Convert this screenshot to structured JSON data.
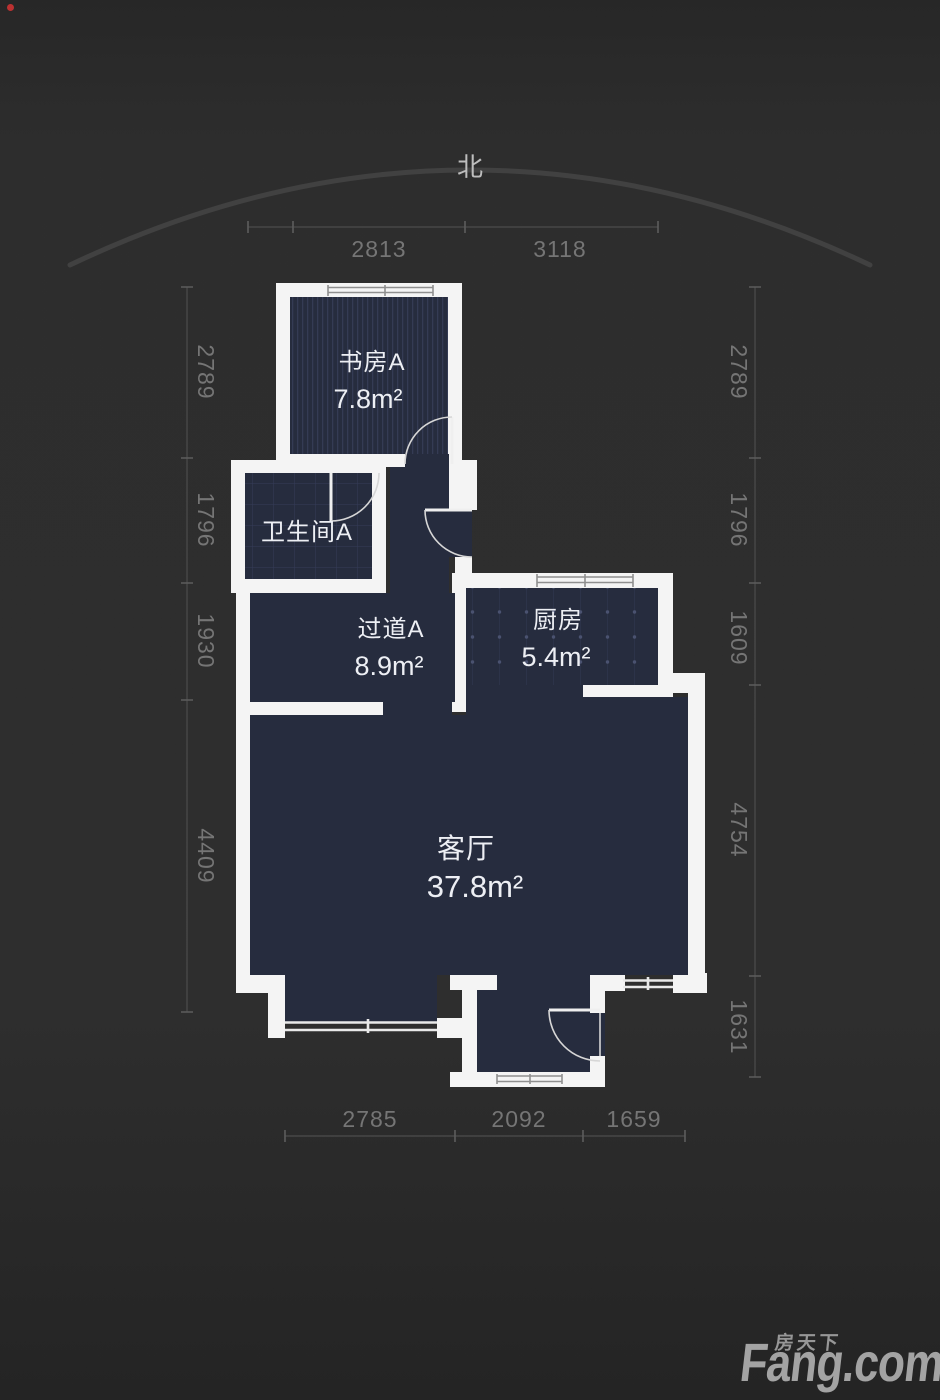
{
  "page": {
    "background": "#2e2e2e"
  },
  "compass": {
    "label": "北"
  },
  "rooms": {
    "study": {
      "name": "书房A",
      "area": "7.8m²"
    },
    "bathroom": {
      "name": "卫生间A"
    },
    "hallway": {
      "name": "过道A",
      "area": "8.9m²"
    },
    "kitchen": {
      "name": "厨房",
      "area": "5.4m²"
    },
    "living": {
      "name": "客厅",
      "area": "37.8m²"
    }
  },
  "dimensions": {
    "top": [
      "2813",
      "3118"
    ],
    "bottom": [
      "2785",
      "2092",
      "1659"
    ],
    "left": [
      "2789",
      "1796",
      "1930",
      "4409"
    ],
    "right": [
      "2789",
      "1796",
      "1609",
      "4754",
      "1631"
    ]
  },
  "logo": {
    "cn": "房天下",
    "en": "Fang.com"
  },
  "colors": {
    "wall": "#f4f4f4",
    "room_fill": "#262c3e",
    "room_text": "#edeff4",
    "dimension_text": "#757575",
    "logo_text": "#a3a3a3",
    "accent_dot": "#cc3333"
  }
}
